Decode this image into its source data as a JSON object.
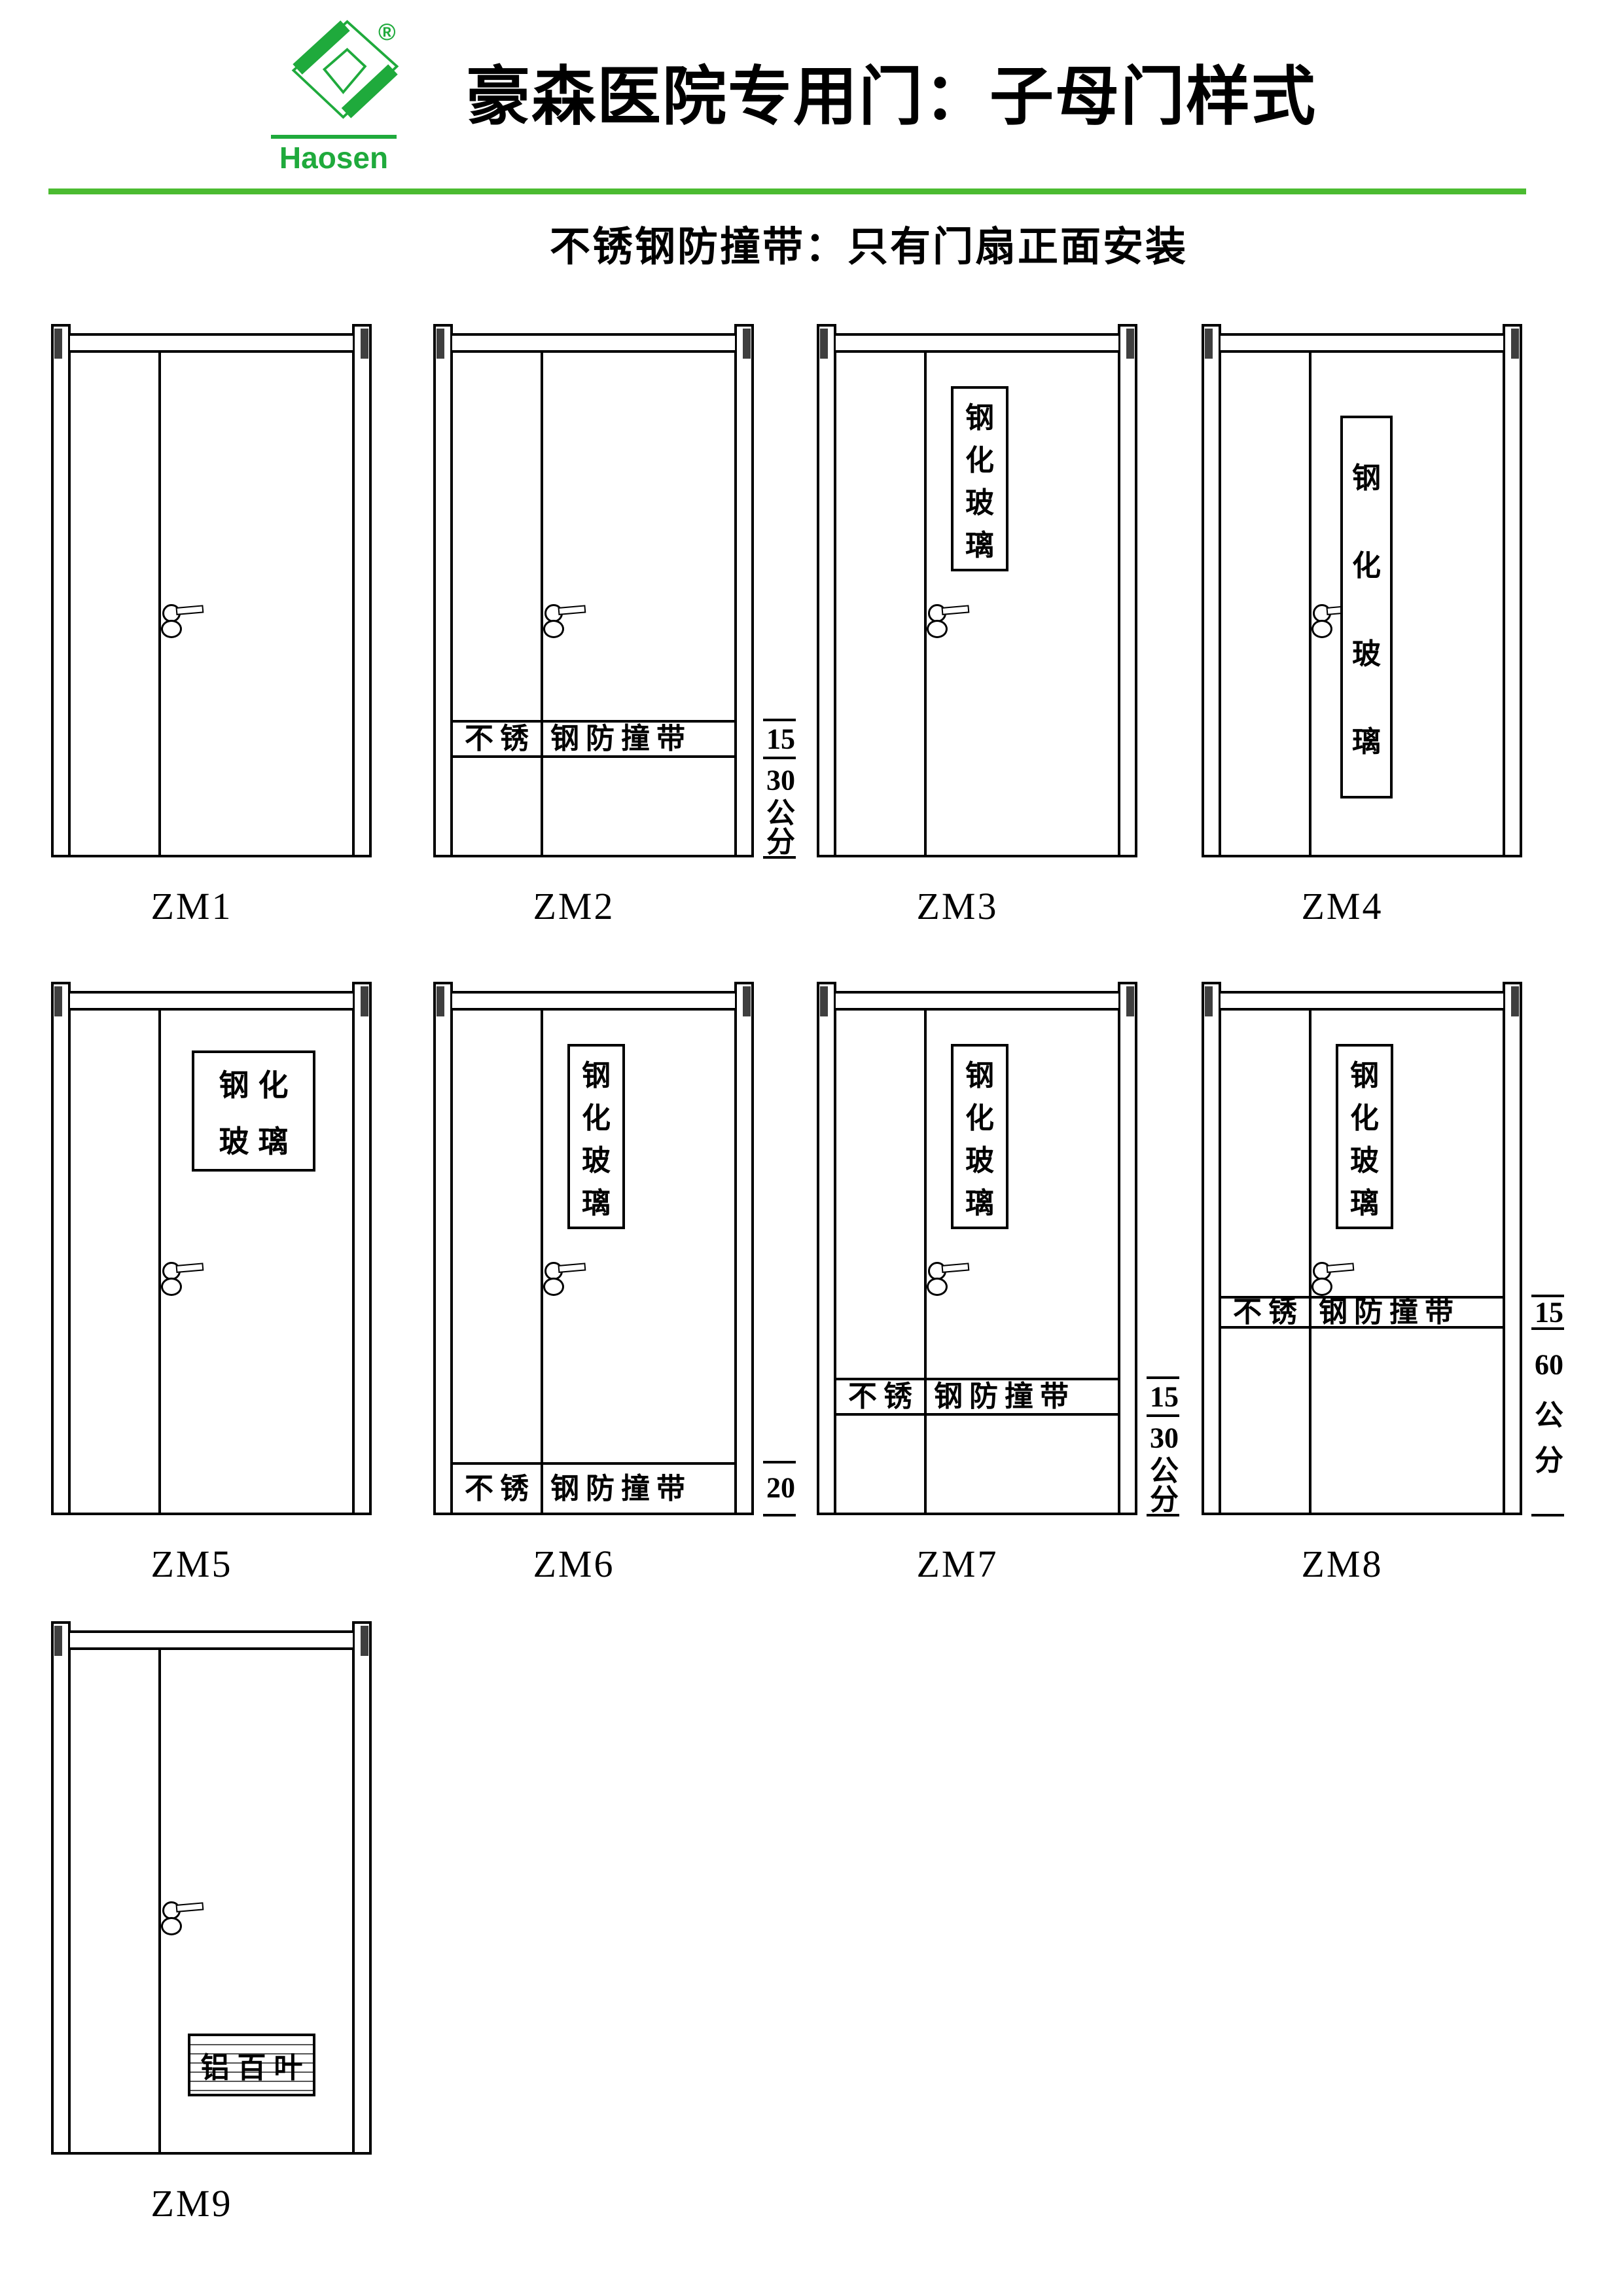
{
  "colors": {
    "brand_green": "#1faa3c",
    "rule_green": "#4bbb31",
    "line_black": "#000000"
  },
  "header": {
    "brand": "Haosen",
    "registered_mark": "®",
    "title": "豪森医院专用门：子母门样式",
    "subtitle": "不锈钢防撞带：只有门扇正面安装"
  },
  "component_texts": {
    "glass_vertical": [
      "钢",
      "化",
      "玻",
      "璃"
    ],
    "glass_tall": [
      "钢",
      "化",
      "玻",
      "璃"
    ],
    "glass_wide_lines": [
      "钢化",
      "玻璃"
    ],
    "band_left": "不锈",
    "band_right": "钢防撞带",
    "louver": "铝百叶"
  },
  "annotation_texts": {
    "15_30": [
      "15",
      "30",
      "公",
      "分"
    ],
    "15_60": [
      "15",
      "60",
      "公",
      "分"
    ],
    "20": [
      "20"
    ]
  },
  "doors": [
    {
      "label": "ZM1",
      "col": 0,
      "row": 0,
      "glass": null,
      "band": null,
      "louver": false
    },
    {
      "label": "ZM2",
      "col": 1,
      "row": 0,
      "glass": null,
      "band": "15_30",
      "louver": false
    },
    {
      "label": "ZM3",
      "col": 2,
      "row": 0,
      "glass": "vertical",
      "band": null,
      "louver": false
    },
    {
      "label": "ZM4",
      "col": 3,
      "row": 0,
      "glass": "tall",
      "band": null,
      "louver": false
    },
    {
      "label": "ZM5",
      "col": 0,
      "row": 1,
      "glass": "wide",
      "band": null,
      "louver": false
    },
    {
      "label": "ZM6",
      "col": 1,
      "row": 1,
      "glass": "vertical",
      "band": "20",
      "louver": false
    },
    {
      "label": "ZM7",
      "col": 2,
      "row": 1,
      "glass": "vertical",
      "band": "15_30",
      "louver": false
    },
    {
      "label": "ZM8",
      "col": 3,
      "row": 1,
      "glass": "vertical",
      "band": "15_60",
      "louver": false
    },
    {
      "label": "ZM9",
      "col": 0,
      "row": 2,
      "glass": null,
      "band": null,
      "louver": true
    }
  ]
}
